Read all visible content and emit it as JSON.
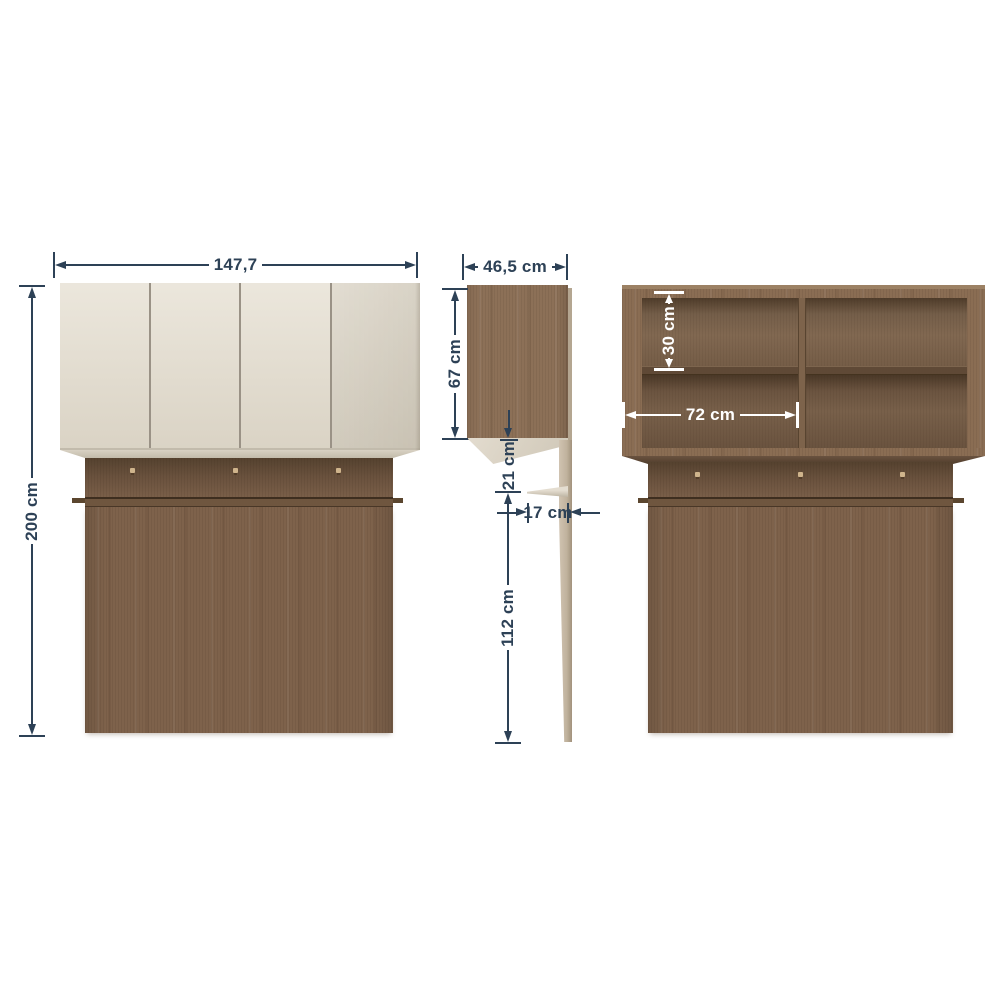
{
  "colors": {
    "background": "#ffffff",
    "dim-line": "#2d4156",
    "dim-white": "#ffffff",
    "door-cream": "#e3dccd",
    "wood-box": "#8c7057",
    "wood-frame": "#8a6d53",
    "wood-panel": "#7e624b",
    "wood-recess-dark": "#55422f",
    "rail": "#6f563f",
    "tan-panel": "#c0b29d",
    "hook": "#cfb48c"
  },
  "views": {
    "front": {
      "width_label": "147,7",
      "height_label": "200 cm"
    },
    "side": {
      "depth_label": "46,5 cm",
      "upper_height_label": "67 cm",
      "gap_label": "21 cm",
      "shelf_depth_label": "17 cm",
      "lower_height_label": "112 cm"
    },
    "interior": {
      "shelf_height_label": "30 cm",
      "compartment_width_label": "72 cm"
    }
  }
}
